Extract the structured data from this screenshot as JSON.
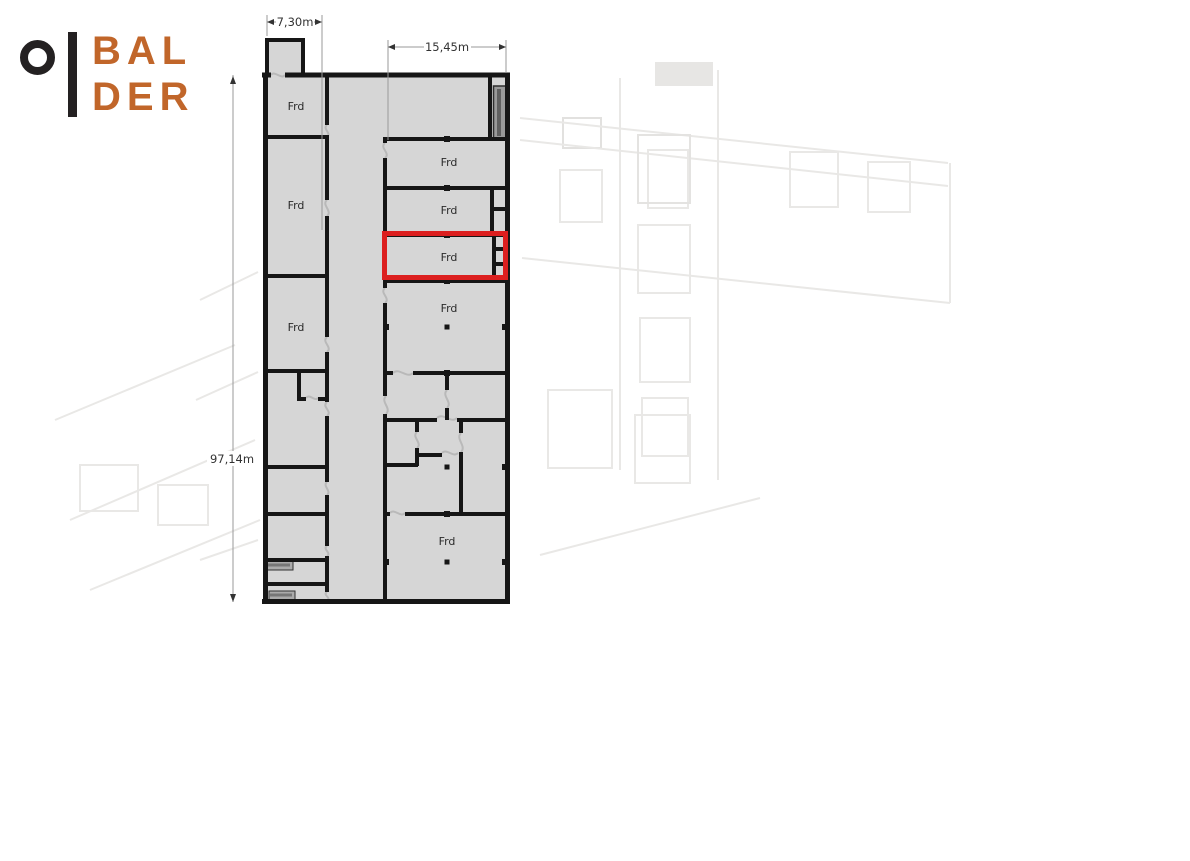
{
  "brand": {
    "line1": "BAL",
    "line2": "DER",
    "text_color": "#c1662a",
    "mark_color": "#242122"
  },
  "plan": {
    "dimensions": {
      "left_wing_width": "7,30m",
      "right_wing_width": "15,45m",
      "total_length": "97,14m"
    },
    "rooms": [
      {
        "id": "left-top",
        "label": "Frd"
      },
      {
        "id": "left-middle",
        "label": "Frd"
      },
      {
        "id": "left-lower",
        "label": "Frd"
      },
      {
        "id": "right-1",
        "label": "Frd"
      },
      {
        "id": "right-2",
        "label": "Frd"
      },
      {
        "id": "right-3-highlighted",
        "label": "Frd"
      },
      {
        "id": "right-4",
        "label": "Frd"
      },
      {
        "id": "right-bottom",
        "label": "Frd"
      }
    ],
    "highlight": {
      "label": "Frd",
      "color": "#dc1f1f"
    },
    "colors": {
      "floor": "#d6d6d6",
      "wall": "#161616",
      "door_mark": "#b9b9b9",
      "shaft": "#9a9a9a",
      "stair": "#ababab",
      "dimension_line": "#999999",
      "label_text": "#2b2b2b"
    }
  }
}
